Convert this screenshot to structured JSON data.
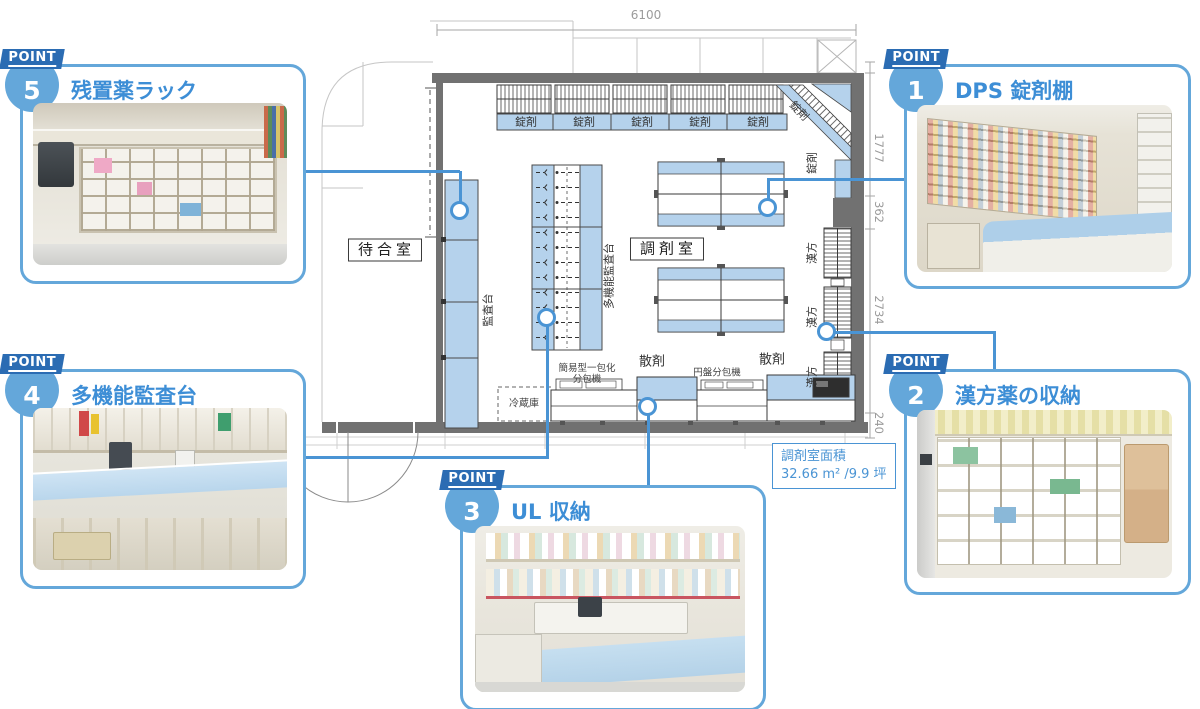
{
  "colors": {
    "accent_blue": "#4a94d4",
    "frame_blue": "#64a7da",
    "ribbon_blue": "#2b6cb3",
    "plan_fill_blue": "#b5d2ec",
    "wall_gray": "#717171"
  },
  "callouts": {
    "p1": {
      "point_word": "POINT",
      "number": "1",
      "title": "DPS 錠剤棚"
    },
    "p2": {
      "point_word": "POINT",
      "number": "2",
      "title": "漢方薬の収納"
    },
    "p3": {
      "point_word": "POINT",
      "number": "3",
      "title": "UL 収納"
    },
    "p4": {
      "point_word": "POINT",
      "number": "4",
      "title": "多機能監査台"
    },
    "p5": {
      "point_word": "POINT",
      "number": "5",
      "title": "残置薬ラック"
    }
  },
  "floor_plan": {
    "room_labels": {
      "waiting_room": "待合室",
      "dispensing_room": "調剤室"
    },
    "shelf_labels": {
      "tablet": "錠剤",
      "kampo": "漢方",
      "audit_counter": "監査台",
      "multi_audit_counter": "多機能監査台"
    },
    "equipment_labels": {
      "refrigerator": "冷蔵庫",
      "simple_packer_line1": "簡易型一包化",
      "simple_packer_line2": "分包機",
      "powder_left": "散剤",
      "disc_packer": "円盤分包機",
      "powder_right": "散剤"
    },
    "dimensions": {
      "top_width": "6100",
      "right_1": "1777",
      "right_2": "362",
      "right_3": "2734",
      "right_4": "240"
    },
    "area_box": {
      "title": "調剤室面積",
      "value": "32.66 m² /9.9 坪"
    }
  }
}
